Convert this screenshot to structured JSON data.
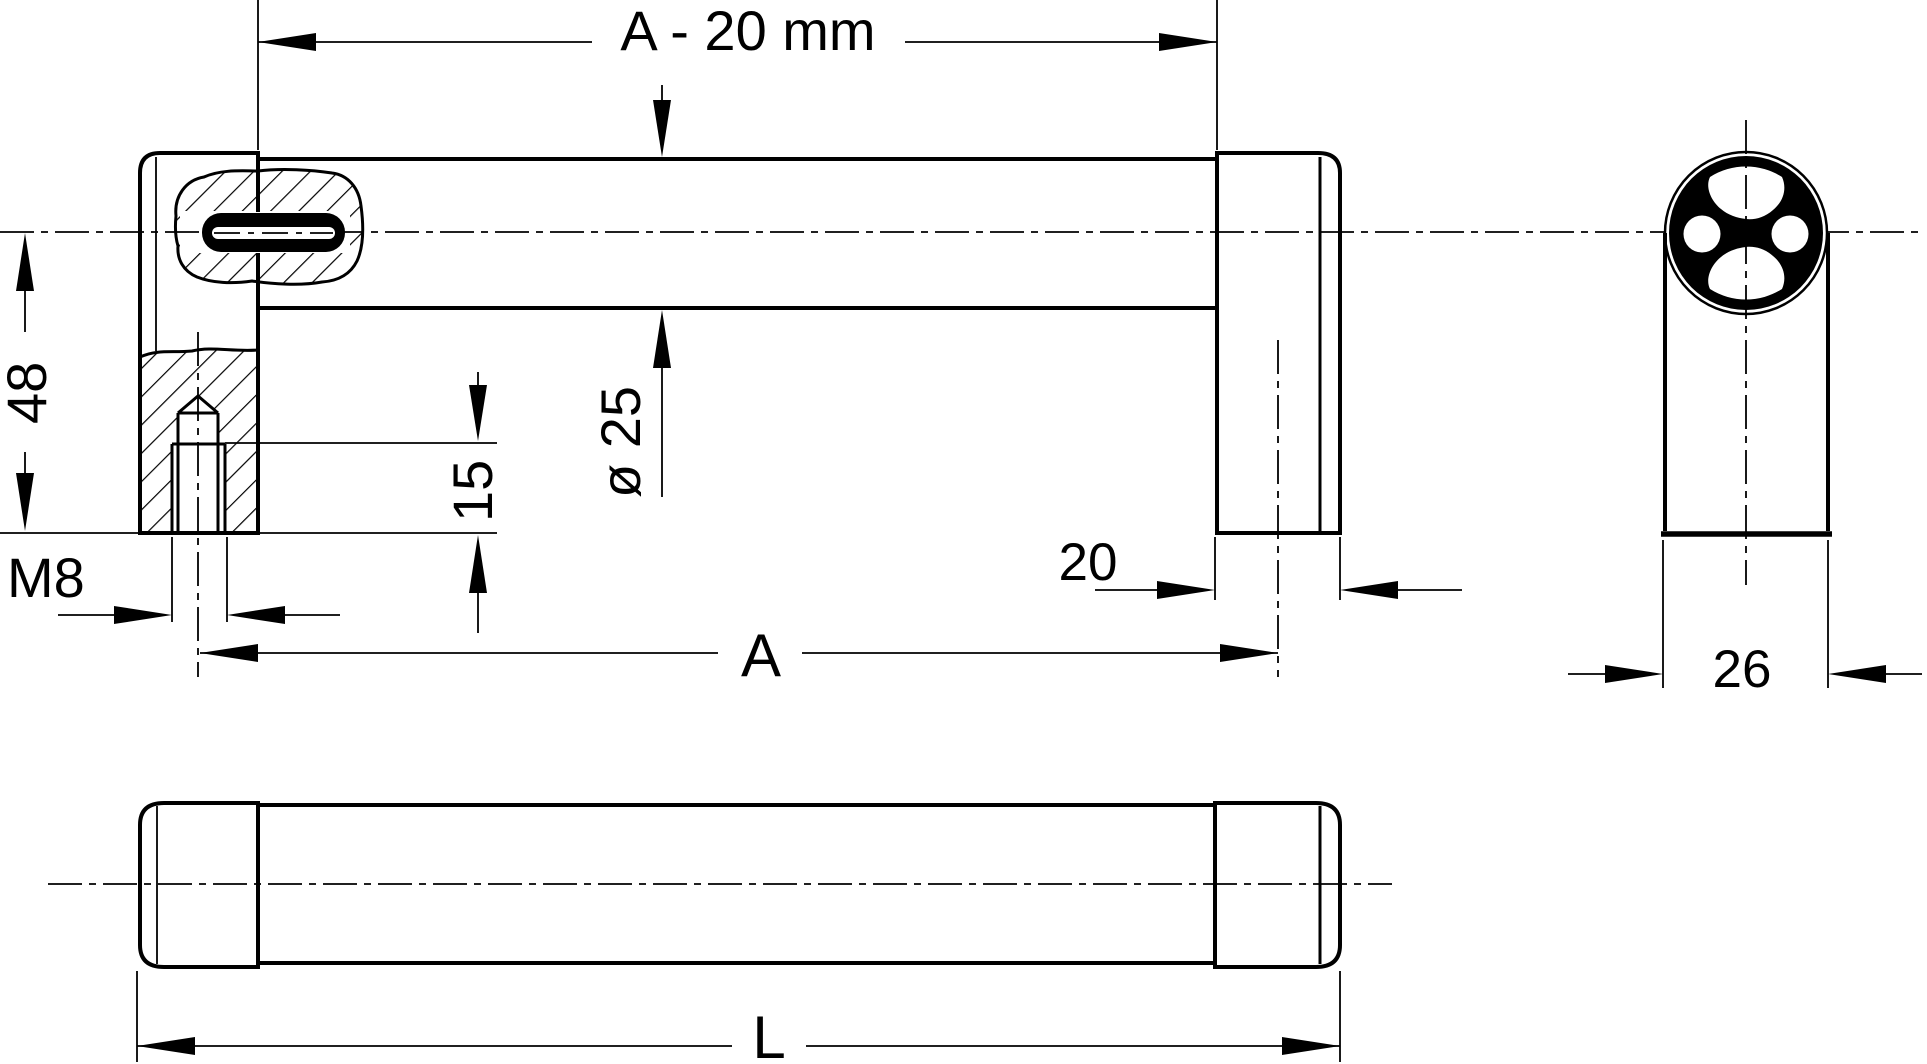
{
  "drawing": {
    "title": "Tubular handle — dimensioned technical drawing",
    "views": {
      "front": "front view with local sections",
      "side": "end view with profile cross-section",
      "bottom": "outside view"
    },
    "labels": {
      "span_minus": "A - 20 mm",
      "height": "48",
      "thread": "M8",
      "thread_depth": "15",
      "tube_dia": "ø 25",
      "cap_len": "20",
      "hole_spacing": "A",
      "profile_dia": "26",
      "overall_len": "L"
    },
    "colors": {
      "line": "#000000",
      "background": "#ffffff"
    }
  }
}
